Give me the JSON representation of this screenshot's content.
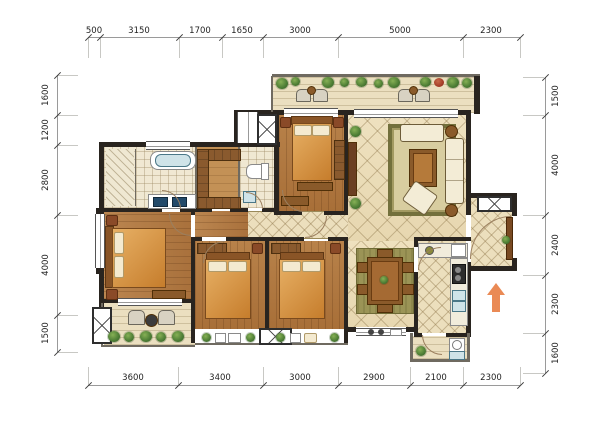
{
  "figure": {
    "type": "apartment-floor-plan",
    "units": "mm"
  },
  "dims": {
    "top": [
      "500",
      "3150",
      "1700",
      "1650",
      "3000",
      "5000",
      "2300"
    ],
    "bottom": [
      "3600",
      "3400",
      "3000",
      "2900",
      "2100",
      "2300"
    ],
    "left": [
      "1600",
      "1200",
      "2800",
      "4000",
      "1500"
    ],
    "right": [
      "1500",
      "4000",
      "2400",
      "2300",
      "1600"
    ]
  },
  "icons": {
    "entry_arrow": "arrow-up",
    "shaft": "crossed-box",
    "plants": "shrub"
  },
  "colors": {
    "wall": "#29241f",
    "wood_floor": "#b8824a",
    "tile_floor": "#ecdfbd",
    "bath_tile": "#f0e8d2",
    "carpet": "#73703c",
    "water": "#cfe3e8",
    "plant_green": "#4a7a33",
    "entry_arrow": "#ea8a55",
    "dimension_line": "#9a9a9a",
    "dimension_text": "#1f1f1f"
  }
}
